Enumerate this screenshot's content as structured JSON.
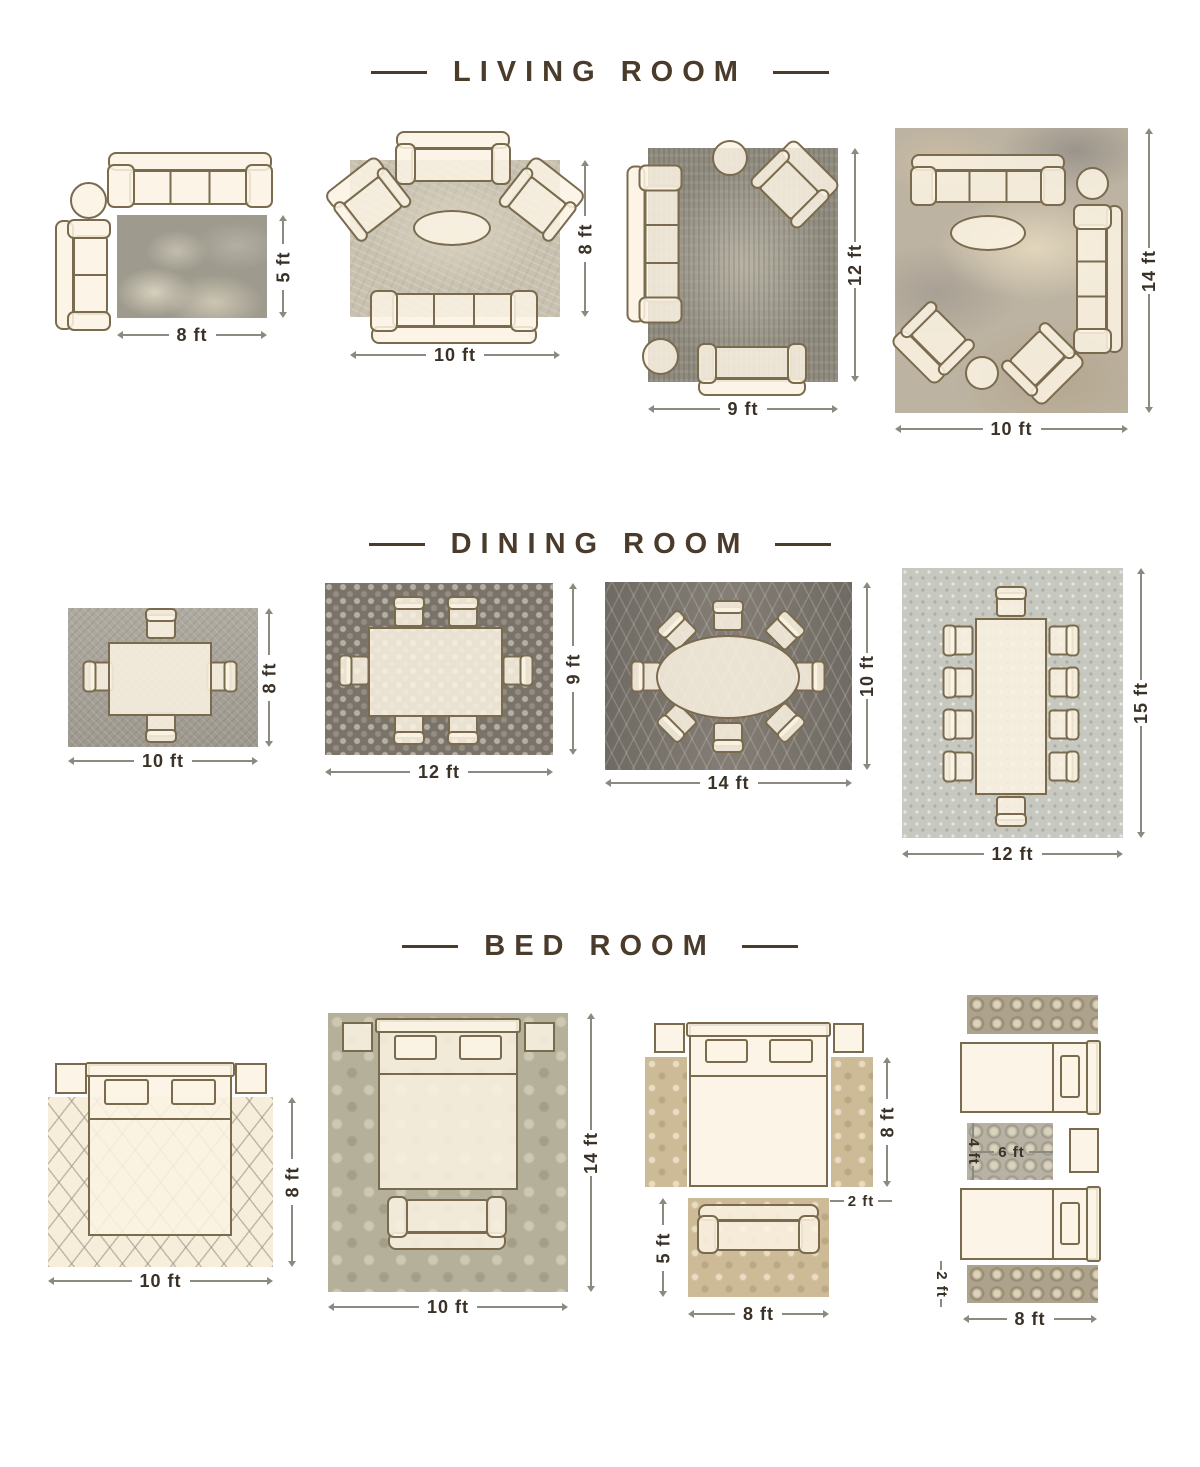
{
  "colors": {
    "background": "#ffffff",
    "title_text": "#4a3b2b",
    "label_text": "#3a3127",
    "furniture_outline": "#7a6a4e",
    "furniture_fill": "#fbf2e1",
    "dim_line": "#8b8a80"
  },
  "living": {
    "title": "LIVING ROOM",
    "layout1": {
      "width": "8 ft",
      "height": "5 ft"
    },
    "layout2": {
      "width": "10 ft",
      "height": "8 ft"
    },
    "layout3": {
      "width": "9 ft",
      "height": "12 ft"
    },
    "layout4": {
      "width": "10 ft",
      "height": "14 ft"
    }
  },
  "dining": {
    "title": "DINING ROOM",
    "layout1": {
      "width": "10 ft",
      "height": "8 ft"
    },
    "layout2": {
      "width": "12 ft",
      "height": "9 ft"
    },
    "layout3": {
      "width": "14 ft",
      "height": "10 ft"
    },
    "layout4": {
      "width": "12 ft",
      "height": "15 ft"
    }
  },
  "bedroom": {
    "title": "BED ROOM",
    "layout1": {
      "width": "10 ft",
      "height": "8 ft"
    },
    "layout2": {
      "width": "10 ft",
      "height": "14 ft"
    },
    "layout3": {
      "bed_height": "8 ft",
      "runner_width": "2 ft",
      "rug_height": "5 ft",
      "rug_width": "8 ft"
    },
    "layout4": {
      "rug_height": "4 ft",
      "rug_width": "6 ft",
      "runner_height": "2 ft",
      "width": "8 ft"
    }
  }
}
